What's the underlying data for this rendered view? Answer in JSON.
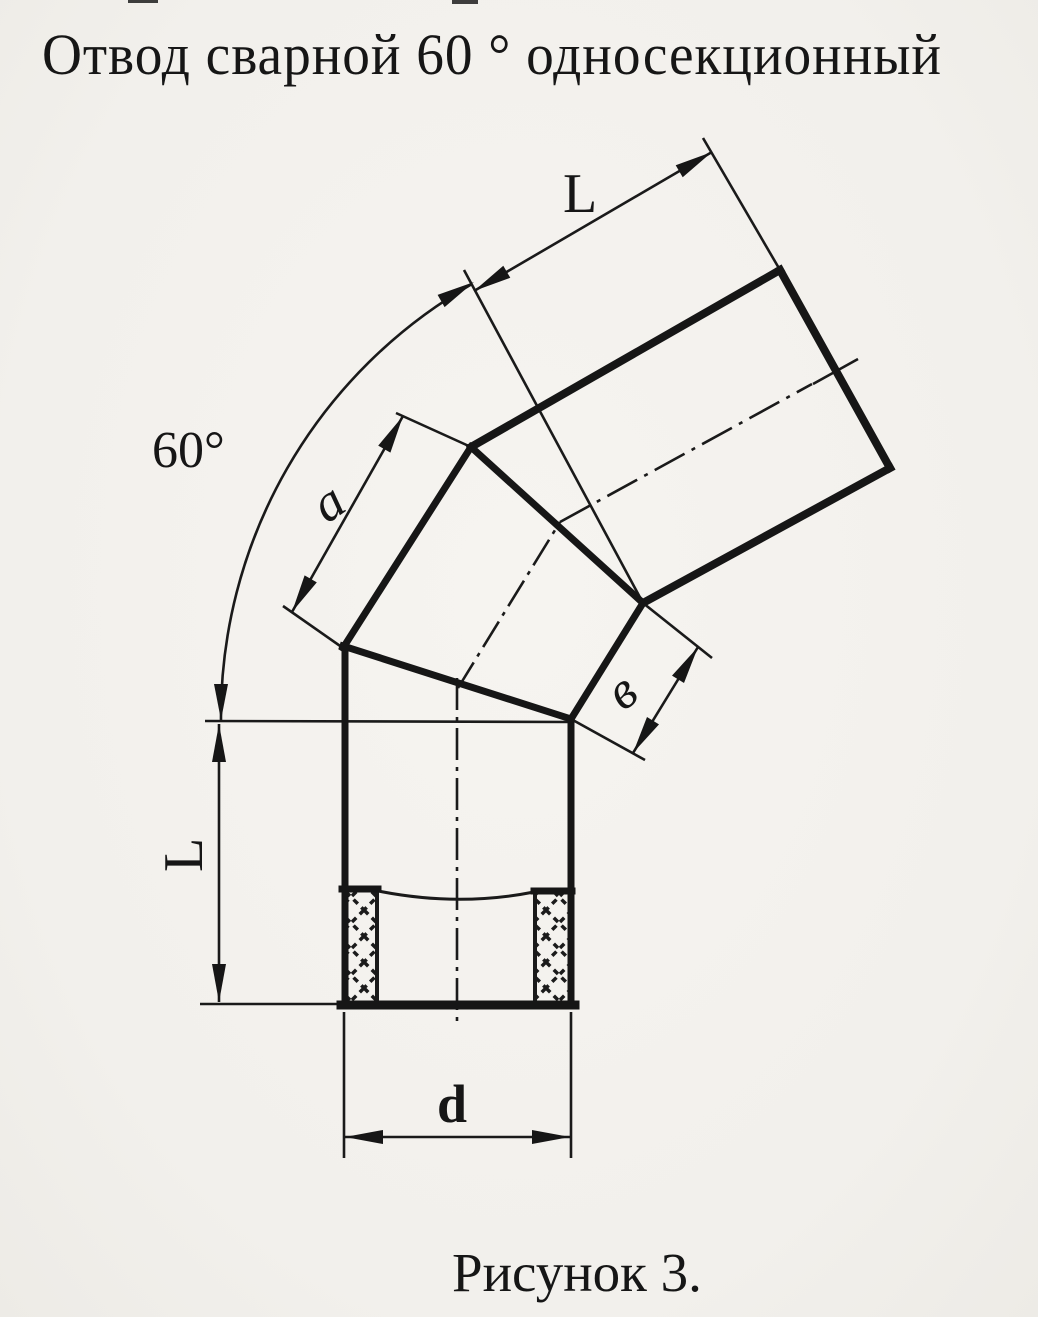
{
  "page": {
    "title": "Отвод сварной 60 ° односекционный",
    "caption": "Рисунок 3."
  },
  "drawing": {
    "subject": "welded 60-degree single-section pipe elbow",
    "angle_label": "60°",
    "top_section_length_label": "L",
    "middle_section_length_label": "a",
    "middle_section_side_label": "в",
    "bottom_section_length_label": "L",
    "diameter_label": "d",
    "ink_color": "#1a1a1a",
    "paper_color": "#f4f2ee"
  }
}
